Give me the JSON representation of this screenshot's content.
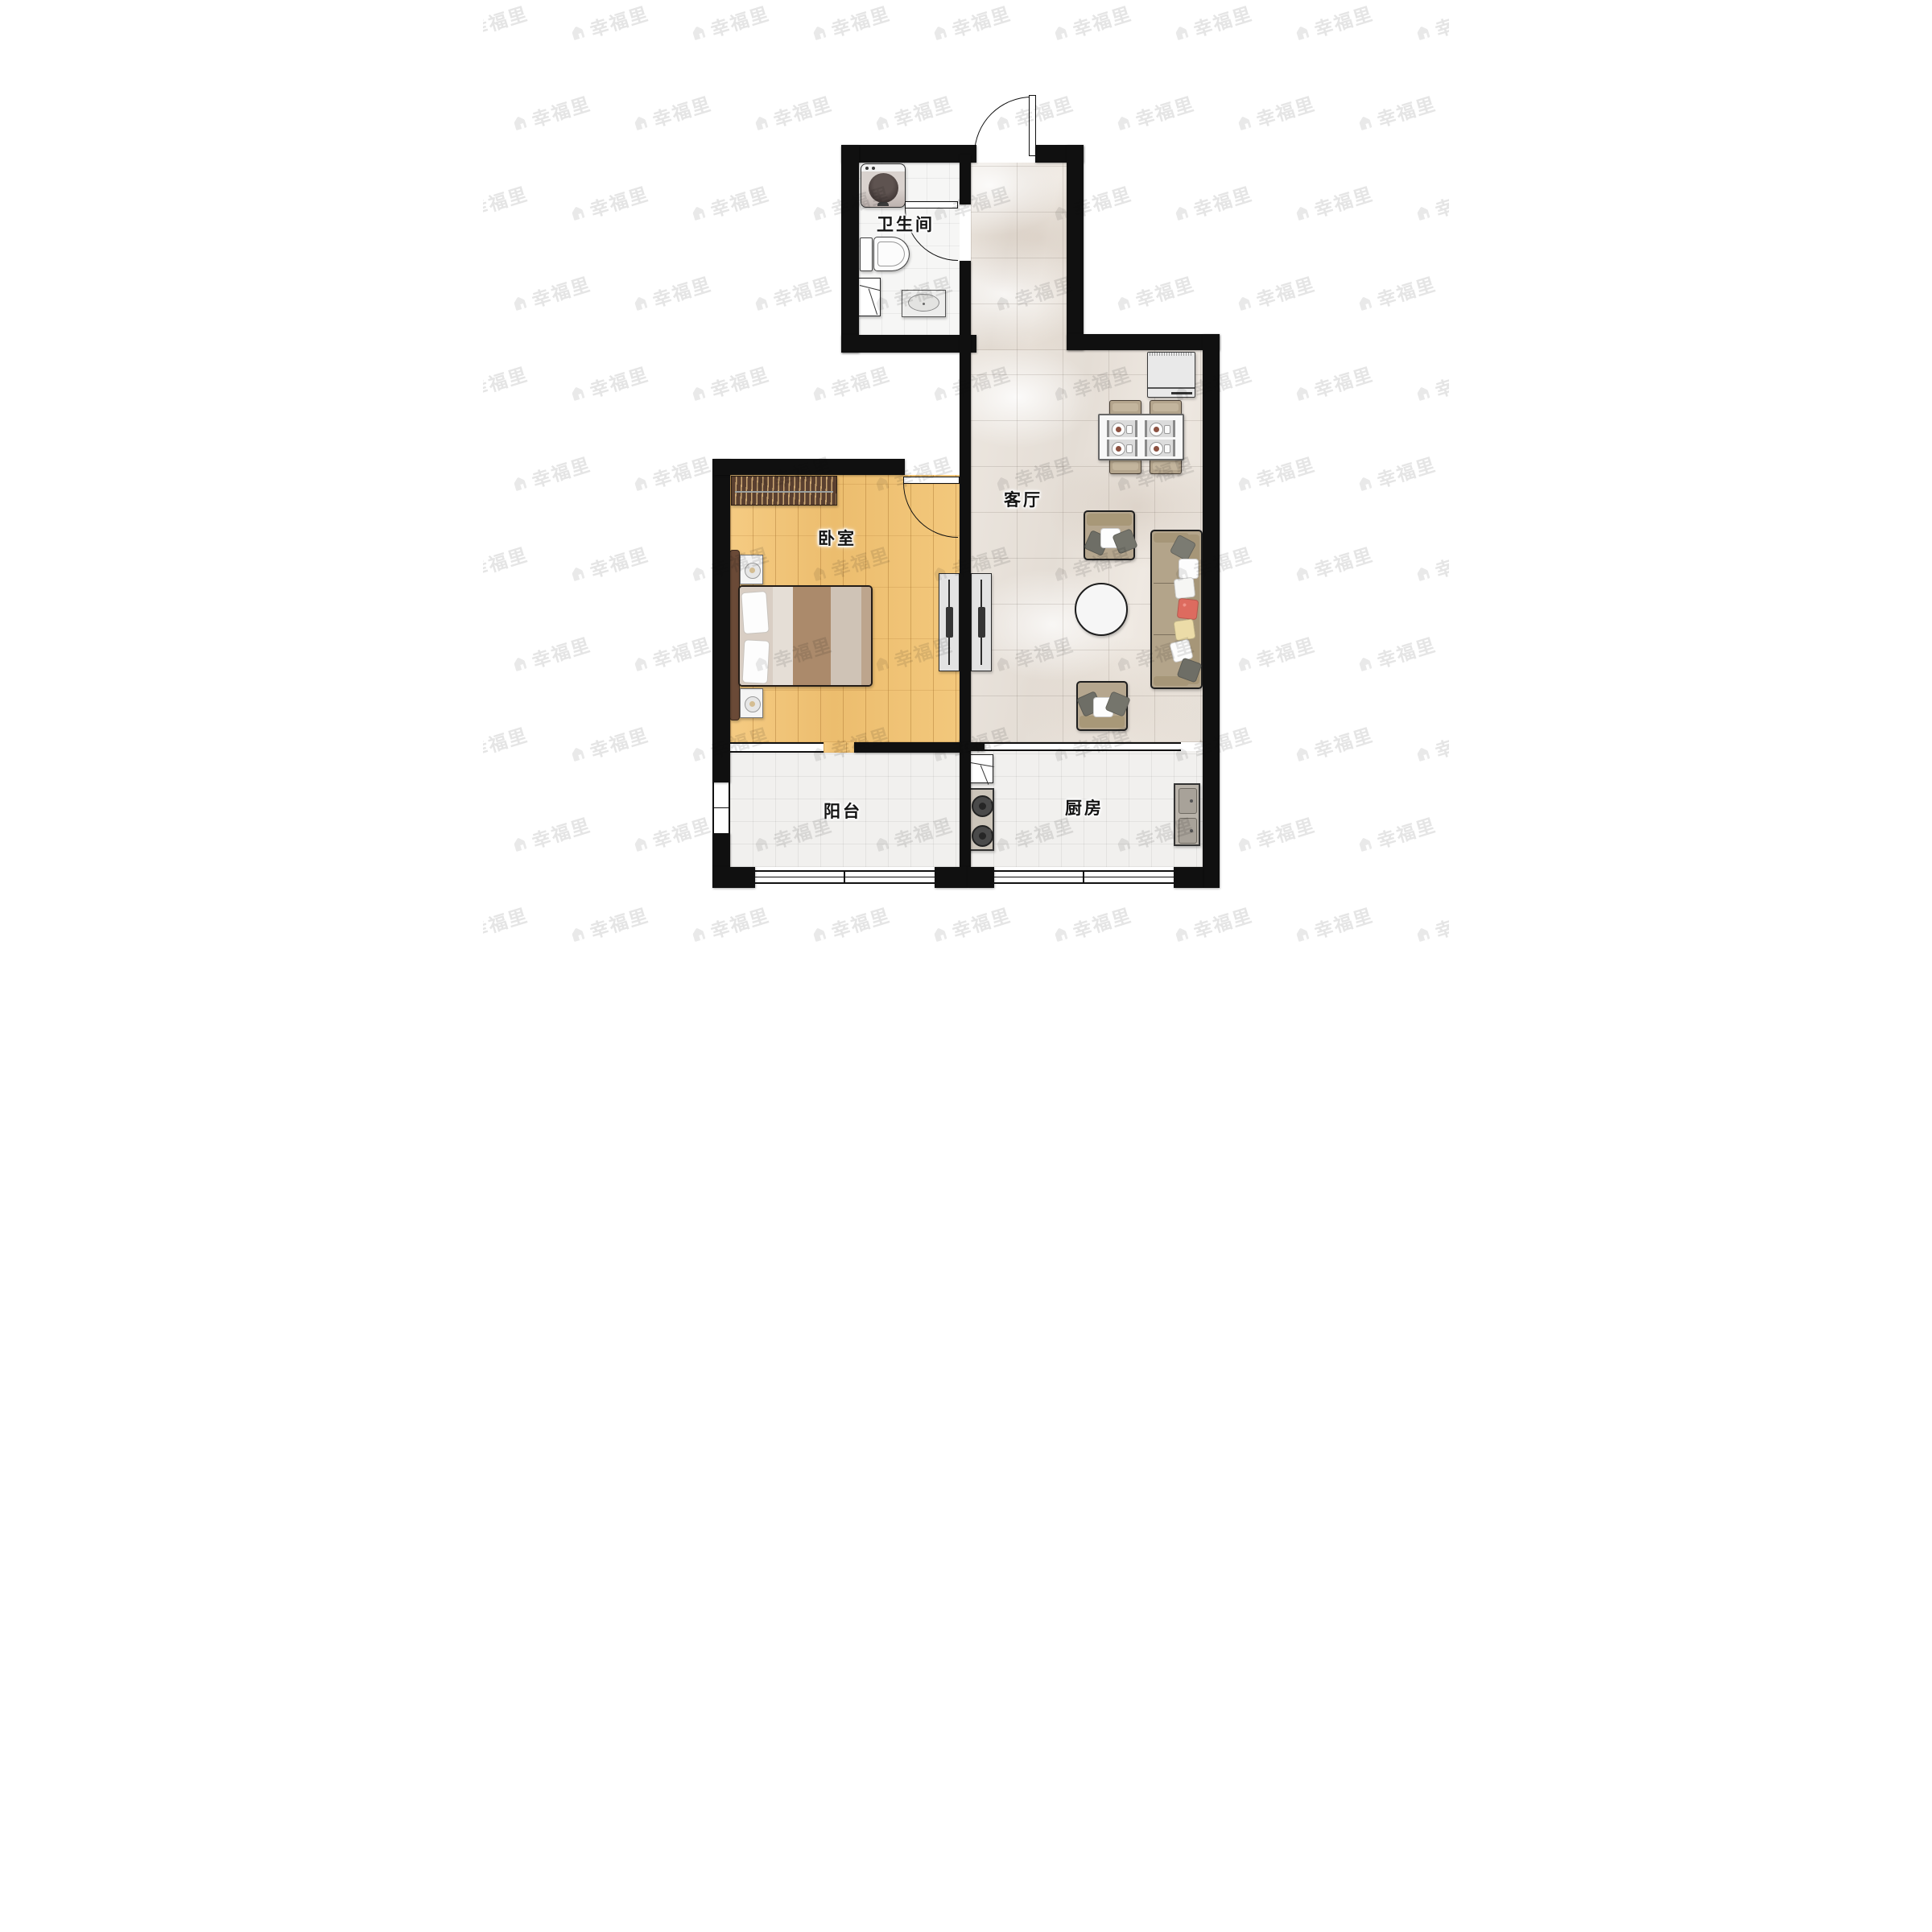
{
  "watermark": {
    "text": "幸福里",
    "icon": "house-icon"
  },
  "rooms": {
    "bathroom": {
      "label": "卫生间",
      "furniture": [
        "washing-machine",
        "toilet",
        "corner-shelf",
        "washbasin"
      ]
    },
    "living_room": {
      "label": "客厅",
      "furniture": [
        "refrigerator",
        "dining-table-4-seats",
        "armchair",
        "armchair",
        "sofa",
        "round-coffee-table",
        "tv-cabinet"
      ]
    },
    "bedroom": {
      "label": "卧室",
      "furniture": [
        "wardrobe",
        "double-bed",
        "nightstand",
        "nightstand",
        "tv-cabinet"
      ]
    },
    "balcony": {
      "label": "阳台",
      "furniture": []
    },
    "kitchen": {
      "label": "厨房",
      "furniture": [
        "corner-cabinet",
        "gas-stove",
        "double-basin-sink"
      ]
    }
  },
  "colors": {
    "wall": "#101010",
    "wood_floor": "#f2c77d",
    "marble_floor": "#eae4dd",
    "tile_floor": "#f1f0ee",
    "bath_tile": "#f6f6f5",
    "sofa_fabric": "#b3a48a",
    "wardrobe_wood": "#5a4030",
    "bed_blanket_brown": "#ab8a6b",
    "accent_pillow_red": "#dd6b5f",
    "accent_pillow_cream": "#ecdca8",
    "watermark_gray": "#e3e3e3"
  }
}
